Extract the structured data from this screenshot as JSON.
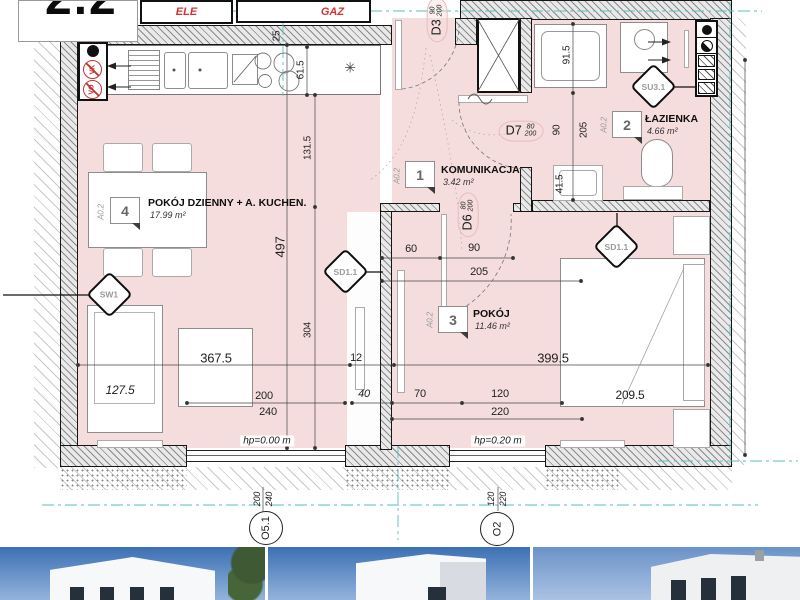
{
  "badge": {
    "number": "2.2"
  },
  "utility": {
    "ele": "ELE",
    "gaz": "GAZ"
  },
  "vents": {
    "vk": "VK",
    "vo": "VO"
  },
  "icons": {
    "ceiling_light": "✳"
  },
  "doors": {
    "d3": {
      "label": "D3",
      "width": "90",
      "height": "200"
    },
    "d7": {
      "label": "D7",
      "width": "80",
      "height": "200"
    },
    "d6": {
      "label": "D6",
      "width": "80",
      "height": "200"
    }
  },
  "rooms": [
    {
      "number": "1",
      "code": "A0.2",
      "name": "KOMUNIKACJA",
      "area": "3.42 m²"
    },
    {
      "number": "2",
      "code": "A0.2",
      "name": "ŁAZIENKA",
      "area": "4.66 m²"
    },
    {
      "number": "3",
      "code": "A0.2",
      "name": "POKÓJ",
      "area": "11.46 m²"
    },
    {
      "number": "4",
      "code": "A0.2",
      "name": "POKÓJ DZIENNY + A. KUCHEN.",
      "area": "17.99 m²"
    }
  ],
  "markers": {
    "sw1": "SW1",
    "sd11_left": "SD1.1",
    "sd11_right": "SD1.1",
    "su31": "SU3.1"
  },
  "levels": {
    "living": "hp=0.00 m",
    "bedroom": "hp=0.20 m"
  },
  "windows": [
    {
      "mark": "O5.1",
      "width": "200",
      "height": "240"
    },
    {
      "mark": "O2",
      "width": "120",
      "height": "220"
    }
  ],
  "dims": {
    "d30": "30",
    "d25": "25",
    "d61_5": "61.5",
    "d497": "497",
    "d131_5": "131.5",
    "d304": "304",
    "d367_5": "367.5",
    "d12": "12",
    "d399_5": "399.5",
    "d127_5": "127.5",
    "d200": "200",
    "d240": "240",
    "d40": "40",
    "d70": "70",
    "d120": "120",
    "d220": "220",
    "d209_5": "209.5",
    "d60": "60",
    "d90": "90",
    "d205": "205",
    "b90": "90",
    "b205": "205",
    "d41_5": "41.5",
    "d91_5": "91.5"
  },
  "colors": {
    "room_fill": "#f6dddd",
    "axis": "#58bdbd",
    "accent_red": "#d03434",
    "wall": "#151515"
  }
}
